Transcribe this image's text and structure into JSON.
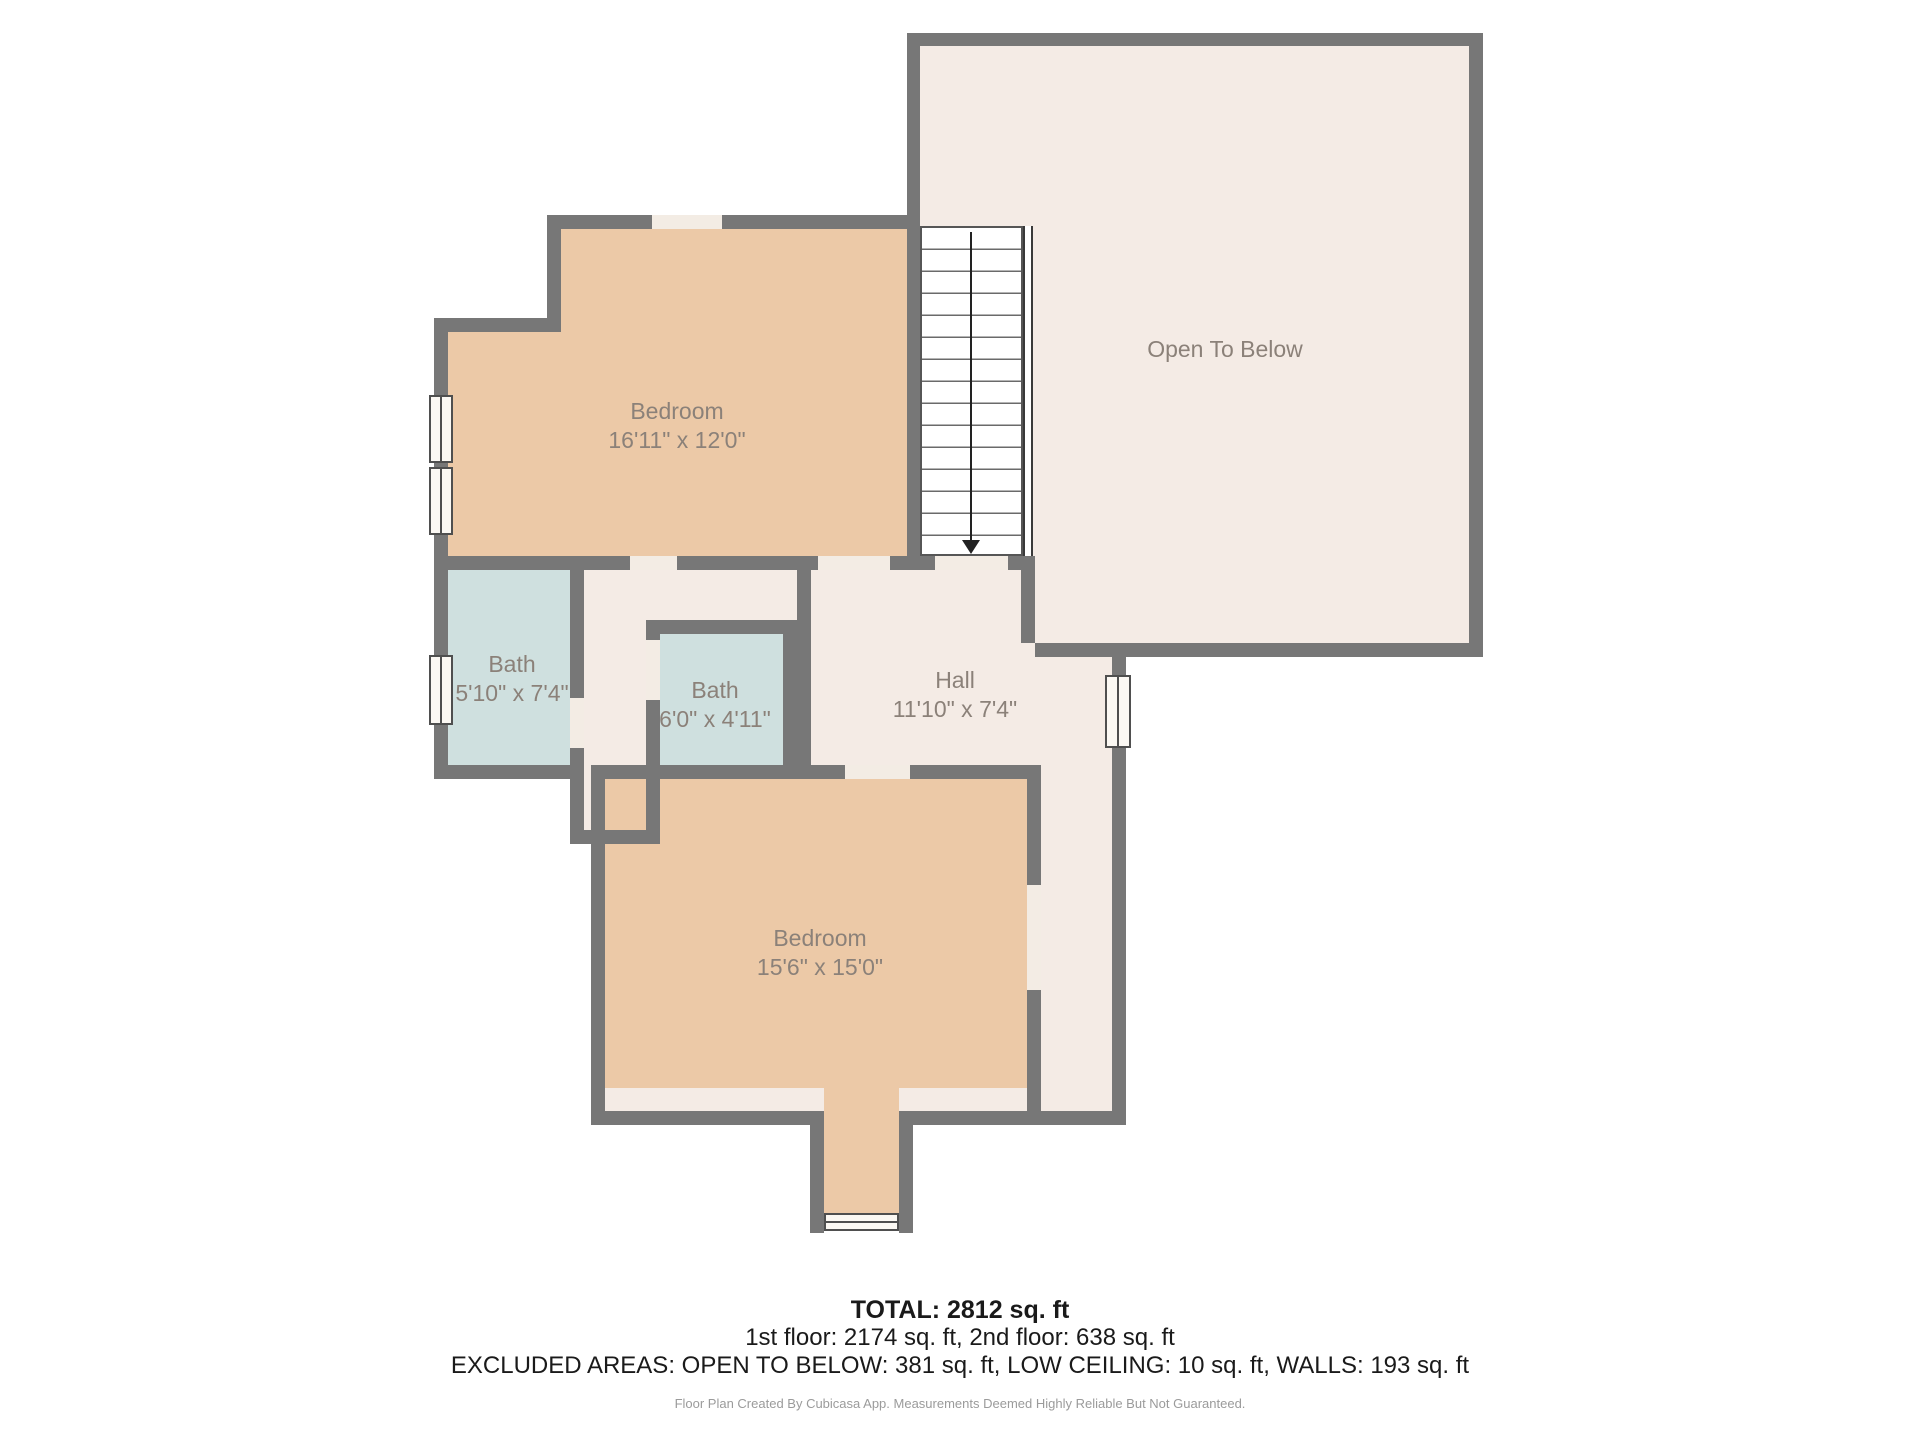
{
  "rooms": [
    {
      "id": "bedroom-upper",
      "name": "Bedroom",
      "dims": "16'11\" x 12'0\""
    },
    {
      "id": "open-to-below",
      "name": "Open To Below",
      "dims": ""
    },
    {
      "id": "bath-left",
      "name": "Bath",
      "dims": "5'10\" x 7'4\""
    },
    {
      "id": "bath-middle",
      "name": "Bath",
      "dims": "6'0\" x 4'11\""
    },
    {
      "id": "hall",
      "name": "Hall",
      "dims": "11'10\" x 7'4\""
    },
    {
      "id": "bedroom-lower",
      "name": "Bedroom",
      "dims": "15'6\" x 15'0\""
    }
  ],
  "summary": {
    "total": "TOTAL: 2812 sq. ft",
    "floors": "1st floor: 2174 sq. ft, 2nd floor: 638 sq. ft",
    "excluded": "EXCLUDED AREAS: OPEN TO BELOW: 381 sq. ft, LOW CEILING: 10 sq. ft, WALLS: 193 sq. ft"
  },
  "footer": "Floor Plan Created By Cubicasa App. Measurements Deemed Highly Reliable But Not Guaranteed.",
  "colors": {
    "wall": "#777777",
    "room_tan": "#ecc9a7",
    "room_blue": "#cfe0df",
    "room_beige": "#f4ebe5",
    "door_gap": "#f3ece4",
    "label_text": "#8b8179"
  }
}
